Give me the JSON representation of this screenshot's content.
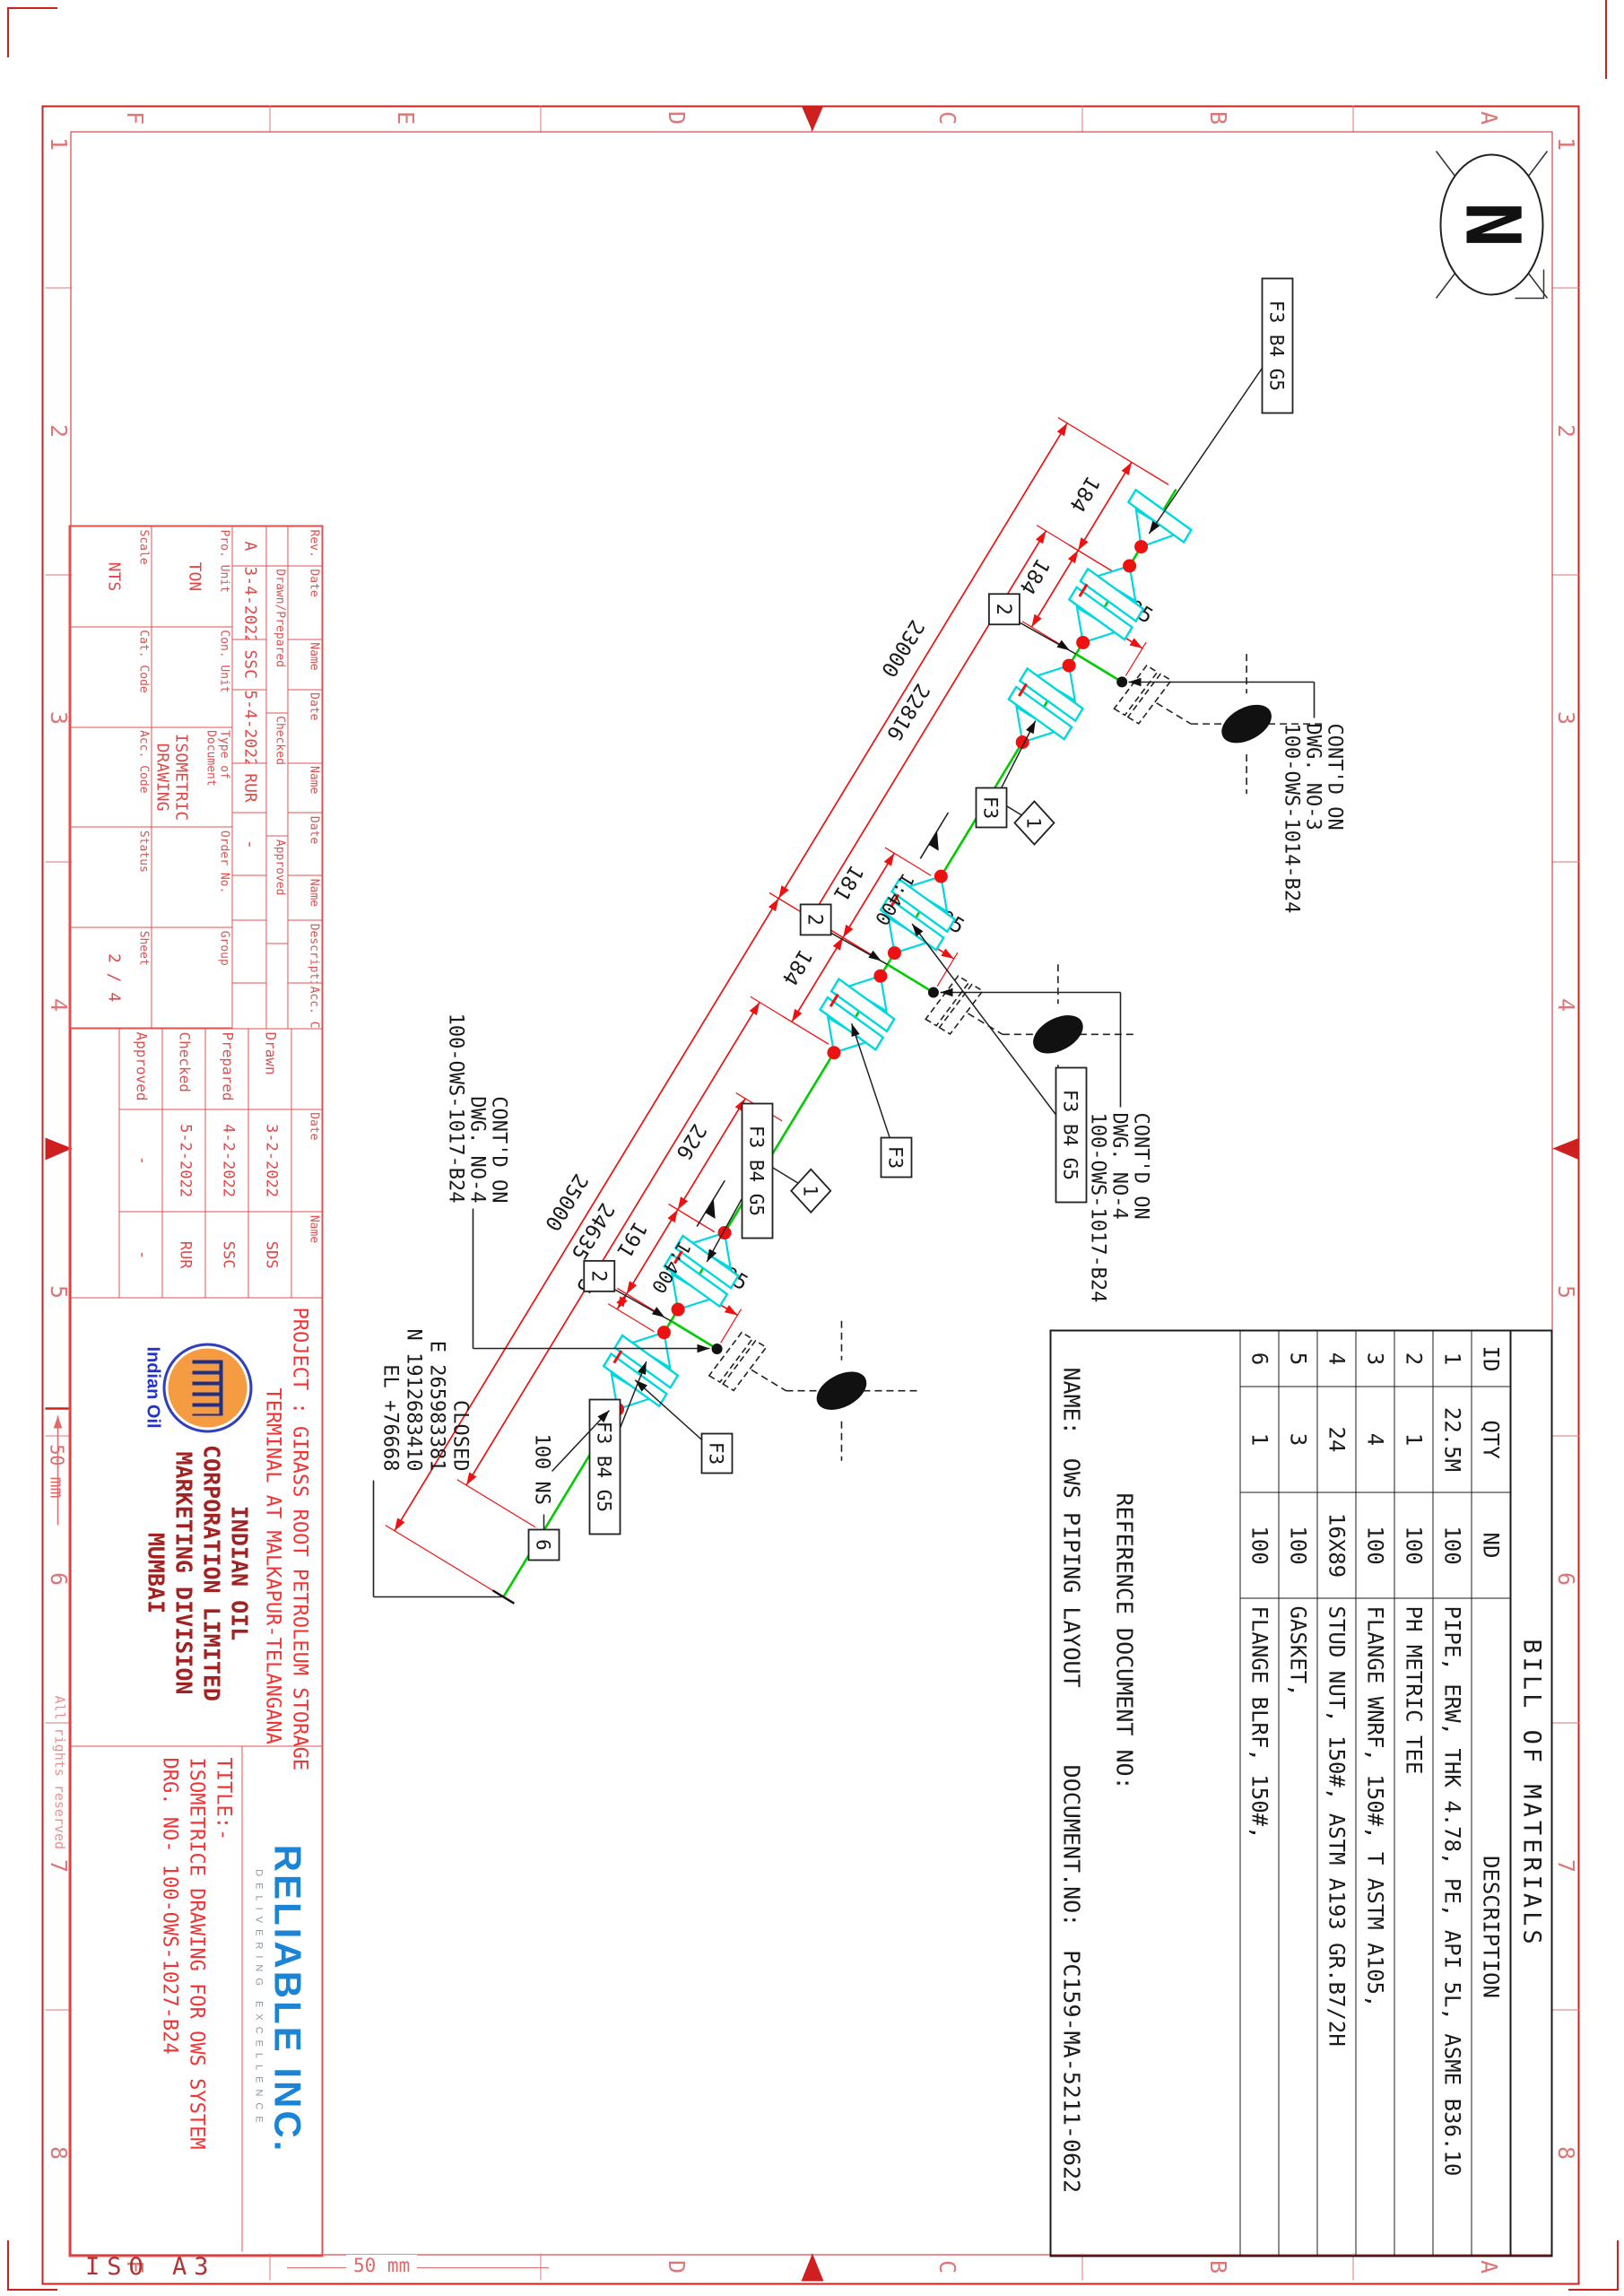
{
  "sheet": {
    "paper": "ISO  A3",
    "scale_label": "50 mm"
  },
  "north_label": "N",
  "frame": {
    "letters": [
      "A",
      "B",
      "C",
      "D",
      "E",
      "F"
    ],
    "numbers": [
      "1",
      "2",
      "3",
      "4",
      "5",
      "6",
      "7",
      "8"
    ],
    "rights": "All rights reserved"
  },
  "bom": {
    "title": "BILL OF MATERIALS",
    "col_id": "ID",
    "col_qty": "QTY",
    "col_nd": "ND",
    "col_desc": "DESCRIPTION",
    "rows": [
      [
        "1",
        "22.5M",
        "100",
        "PIPE, ERW, THK 4.78, PE, API 5L, ASME B36.10"
      ],
      [
        "2",
        "1",
        "100",
        "PH METRIC TEE"
      ],
      [
        "3",
        "4",
        "100",
        "FLANGE WNRF, 150#, T ASTM A105,"
      ],
      [
        "4",
        "24",
        "16X89",
        "STUD NUT, 150#, ASTM A193 GR.B7/2H"
      ],
      [
        "5",
        "3",
        "100",
        "GASKET,"
      ],
      [
        "6",
        "1",
        "100",
        "FLANGE BLRF, 150#,"
      ]
    ],
    "reference": "REFERENCE  DOCUMENT  NO:",
    "name_label": "NAME:",
    "name_value": "OWS  PIPING  LAYOUT",
    "doc_label": "DOCUMENT.NO:",
    "doc_value": "PC159-MA-5211-0622"
  },
  "titleblock": {
    "rev_headers": [
      "Rev.",
      "Date",
      "Name",
      "Date",
      "Name",
      "Date",
      "Name",
      "Description",
      "Acc. Code"
    ],
    "rev_sub": [
      "Drawn/Prepared",
      "Checked",
      "Approved"
    ],
    "rev_row": [
      "A",
      "3-4-2022",
      "SSC",
      "5-4-2022",
      "RUR",
      "-",
      ""
    ],
    "fields": [
      {
        "label": "Pro. Unit",
        "value": "TON"
      },
      {
        "label": "Con. Unit",
        "value": ""
      },
      {
        "label": "Type of Document",
        "value": "ISOMETRIC DRAWING"
      },
      {
        "label": "Order No.",
        "value": ""
      },
      {
        "label": "Group",
        "value": ""
      },
      {
        "label": "Scale",
        "value": "NTS"
      },
      {
        "label": "Cat. Code",
        "value": ""
      },
      {
        "label": "Acc. Code",
        "value": ""
      },
      {
        "label": "Status",
        "value": ""
      },
      {
        "label": "Sheet",
        "value": "2 / 4"
      }
    ],
    "signoff_date": "Date",
    "signoff_name": "Name",
    "signoff": [
      [
        "Drawn",
        "3-2-2022",
        "SDS"
      ],
      [
        "Prepared",
        "4-2-2022",
        "SSC"
      ],
      [
        "Checked",
        "5-2-2022",
        "RUR"
      ],
      [
        "Approved",
        "-",
        "-"
      ]
    ],
    "project_line1": "PROJECT : GIRASS ROOT PETROLEUM STORAGE",
    "project_line2": "TERMINAL AT MALKAPUR-TELANGANA",
    "oil_logo_caption": "Indian Oil",
    "company": [
      "INDIAN  OIL",
      "CORPORATION  LIMITED",
      "MARKETING  DIVISION",
      "MUMBAI"
    ],
    "vendor": "RELIABLE INC.",
    "vendor_tag": "DELIVERING EXCELLENCE",
    "title_label": "TITLE:-",
    "title_line1": "ISOMETRICE  DRAWING  FOR  OWS  SYSTEM",
    "title_line2": "DRG. NO-  100-OWS-1027-B24"
  },
  "iso": {
    "dims": {
      "d184a": "184",
      "d184b": "184",
      "d23000": "23000",
      "d22816": "22816",
      "d181": "181",
      "d184c": "184",
      "d25000": "25000",
      "d24635": "24635",
      "d226": "226",
      "d191": "191",
      "d35": "35",
      "d105": "105"
    },
    "slope": "1:400",
    "balloon_pipe": "1",
    "balloon_tee": "2",
    "balloon_blind": "6",
    "f3": "F3",
    "f3b4g5": "F3 B4 G5",
    "size_ns": "100 NS",
    "contd": [
      [
        "CONT'D ON",
        "DWG. NO-3",
        "100-OWS-1014-B24"
      ],
      [
        "CONT'D ON",
        "DWG. NO-4",
        "100-OWS-1017-B24"
      ],
      [
        "CONT'D ON",
        "DWG. NO-4",
        "100-OWS-1017-B24"
      ]
    ],
    "closed": [
      "CLOSED",
      "E 265983381",
      "N 1912683410",
      "EL +76668"
    ]
  }
}
